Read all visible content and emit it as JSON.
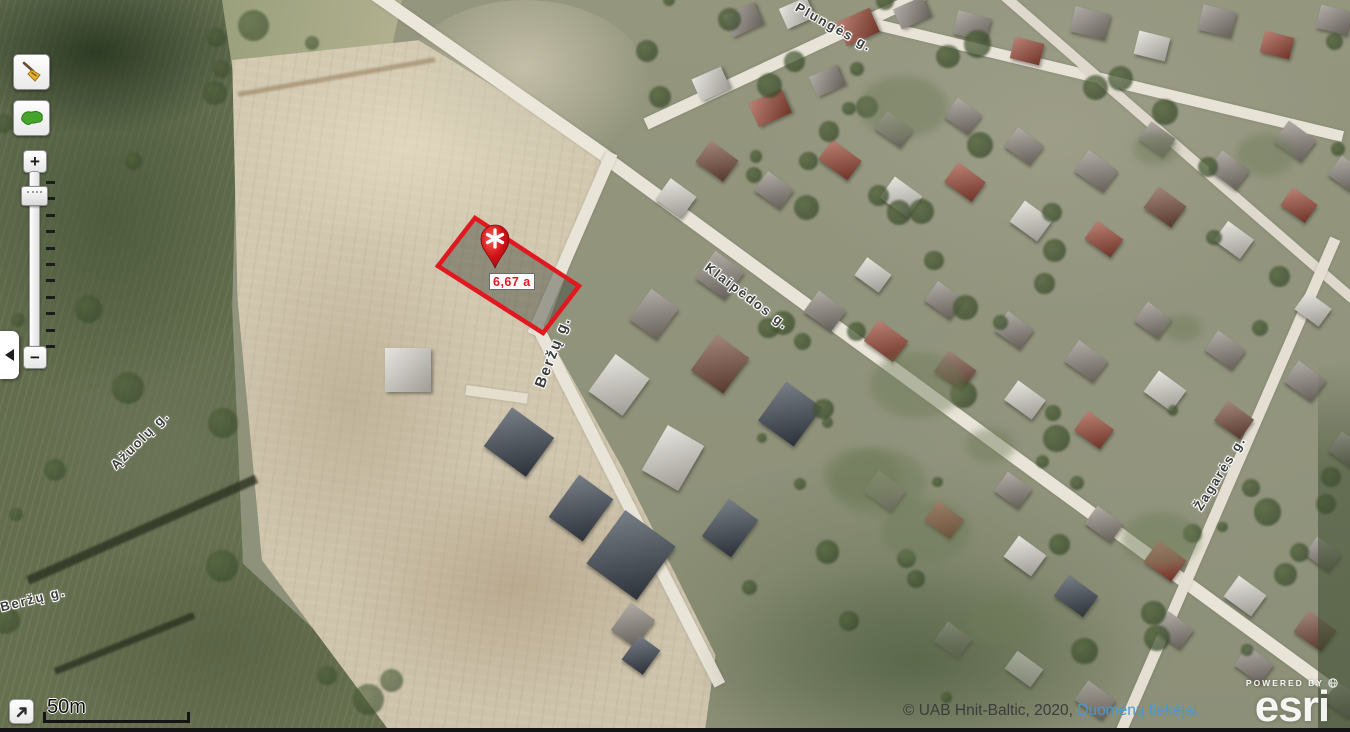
{
  "map": {
    "plot": {
      "area_label": "6,67 a"
    },
    "streets": [
      {
        "name": "Plungės g."
      },
      {
        "name": "Klaipėdos g."
      },
      {
        "name": "Beržų g."
      },
      {
        "name": "Ąžuolų g."
      },
      {
        "name": "Žagarės g."
      },
      {
        "name": "Beržų g."
      }
    ]
  },
  "toolbar": {
    "clear_tool_icon": "broom-icon",
    "extent_tool_icon": "lithuania-map-icon"
  },
  "zoom_control": {
    "zoom_in": "+",
    "zoom_out": "−"
  },
  "scale_bar": {
    "label": "50m"
  },
  "attribution": {
    "text": "© UAB Hnit-Baltic, 2020, ",
    "link": "Duomenų tiekėjai"
  },
  "branding": {
    "powered_by": "POWERED BY",
    "brand": "esri"
  },
  "colors": {
    "plot_outline": "#e01820",
    "marker_red": "#d41317",
    "area_label_text": "#e01820",
    "attribution_link": "#4a97d2"
  }
}
